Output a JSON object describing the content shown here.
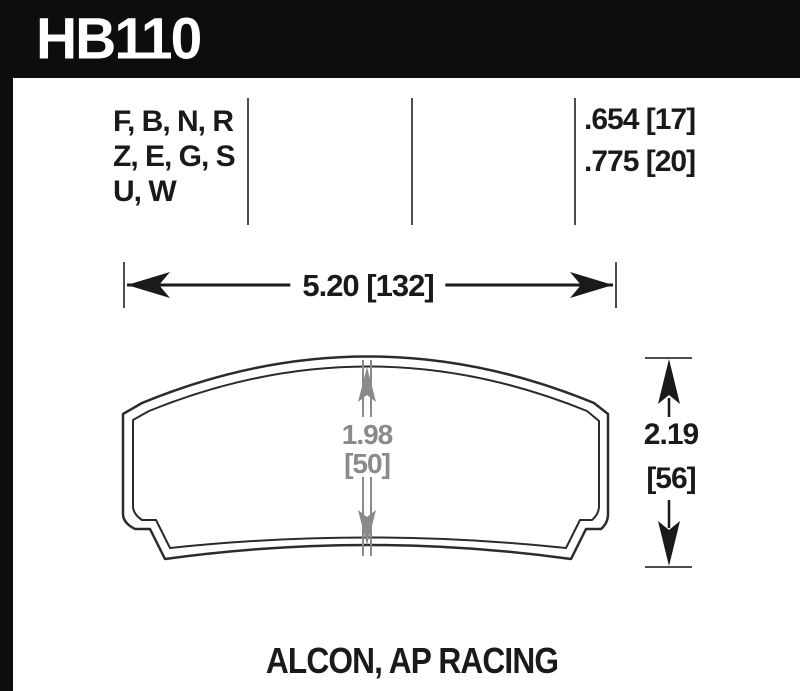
{
  "part_number": "HB110",
  "compound_codes": {
    "line1": "F, B, N, R",
    "line2": "Z, E, G, S",
    "line3": "U, W"
  },
  "pad_thickness": {
    "line1": ".654 [17]",
    "line2": ".775 [20]"
  },
  "dimensions": {
    "overall_width": "5.20 [132]",
    "friction_height_value": "1.98",
    "friction_height_bracket": "[50]",
    "overall_height_value": "2.19",
    "overall_height_bracket": "[56]"
  },
  "applications": "ALCON, AP RACING",
  "colors": {
    "ink": "#1a1a1a",
    "dimension_gray": "#8a8a8a",
    "rule_gray": "#4d4d4d",
    "header_bg": "#0d0d0d"
  }
}
